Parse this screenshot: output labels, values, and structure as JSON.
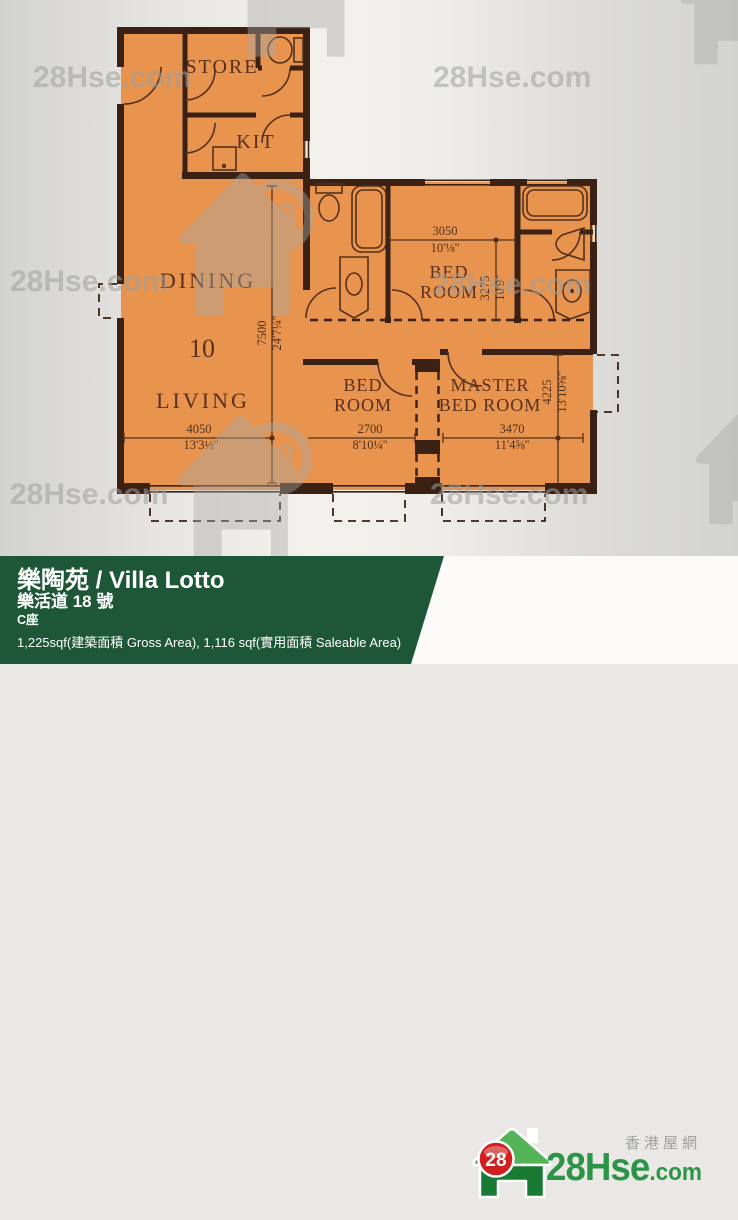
{
  "watermark": {
    "text": "28Hse.com",
    "badge": "28"
  },
  "plan": {
    "rooms": {
      "store": "STORE",
      "kitchen": "KIT",
      "dining": "DINING",
      "living": "LIVING",
      "unit_number": "10",
      "bedroom_line1": "BED",
      "bedroom_line2": "ROOM",
      "master_line1": "MASTER",
      "master_line2": "BED ROOM"
    },
    "dims": {
      "living_w_mm": "4050",
      "living_w_ft": "13'3½''",
      "depth_mm": "7500",
      "depth_ft": "24'7¼''",
      "bed1_w_mm": "3050",
      "bed1_w_ft": "10'⅛''",
      "bed1_d_mm": "3275",
      "bed1_d_ft": "10'9''",
      "bed2_w_mm": "2700",
      "bed2_w_ft": "8'10¼''",
      "master_w_mm": "3470",
      "master_w_ft": "11'4⅝''",
      "master_d_mm": "4225",
      "master_d_ft": "13'10⅝''"
    }
  },
  "info_bar": {
    "title": "樂陶苑 / Villa Lotto",
    "address": "樂活道 18 號",
    "block": "C座",
    "area": "1,225sqf(建築面積 Gross Area), 1,116 sqf(實用面積 Saleable Area)"
  },
  "logo": {
    "badge": "28",
    "brand": "28Hse",
    "suffix": ".com",
    "tagline": "香港屋網"
  },
  "colors": {
    "floor_orange": "#e8934e",
    "wall_brown": "#3a2113",
    "plan_text": "#59301d",
    "green_bar": "#1e5737",
    "logo_green": "#2b9447",
    "logo_red": "#d01f1f",
    "watermark_gray": "#a9a9a6"
  }
}
